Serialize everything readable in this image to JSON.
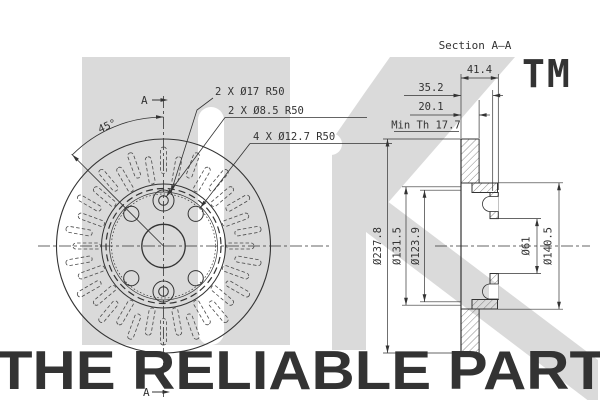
{
  "watermark": {
    "tm": "TM",
    "slogan": "THE RELIABLE PART",
    "logo_gray": "#dadada",
    "slogan_gray": "#d2d2d2"
  },
  "front_view": {
    "section_marker_top": "A",
    "section_marker_bottom": "A",
    "angle_label": "45°",
    "hole_labels": [
      "2 X Ø17 R50",
      "2 X Ø8.5 R50",
      "4 X Ø12.7 R50"
    ]
  },
  "section_view": {
    "title": "Section A–A",
    "overall_width": "41.4",
    "hat_depth": "35.2",
    "disc_thickness": "20.1",
    "min_thickness": "Min Th 17.7",
    "outer_diameter": "Ø237.8",
    "friction_od_inner": "Ø131.5",
    "friction_id_inner": "Ø123.9",
    "center_bore": "Ø61",
    "hat_diameter": "Ø140.5"
  },
  "line_color": "#3a3a3a"
}
